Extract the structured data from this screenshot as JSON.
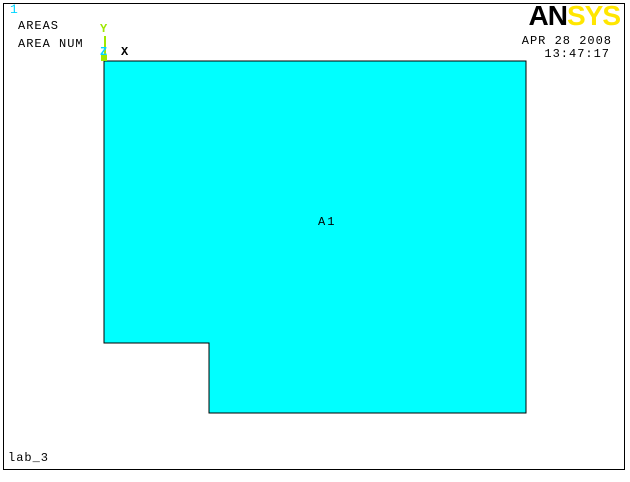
{
  "window": {
    "plot_number": "1",
    "annotations": [
      "AREAS",
      "AREA NUM"
    ],
    "footer_label": "lab_3"
  },
  "logo": {
    "black_part": "AN",
    "yellow_part": "SYS"
  },
  "datetime": {
    "date": "APR 28 2008",
    "time": "13:47:17"
  },
  "triad": {
    "x": "X",
    "y": "Y",
    "z": "Z"
  },
  "model": {
    "area_label": "A1",
    "area_points": "104,61 526,61 526,413 209,413 209,343 104,343"
  },
  "colors": {
    "area_fill": "#00FFFF",
    "area_outline": "#000000",
    "logo_yellow": "#FFE600",
    "triad_green": "#9FE800",
    "plot_number_cyan": "#00D5FF"
  }
}
